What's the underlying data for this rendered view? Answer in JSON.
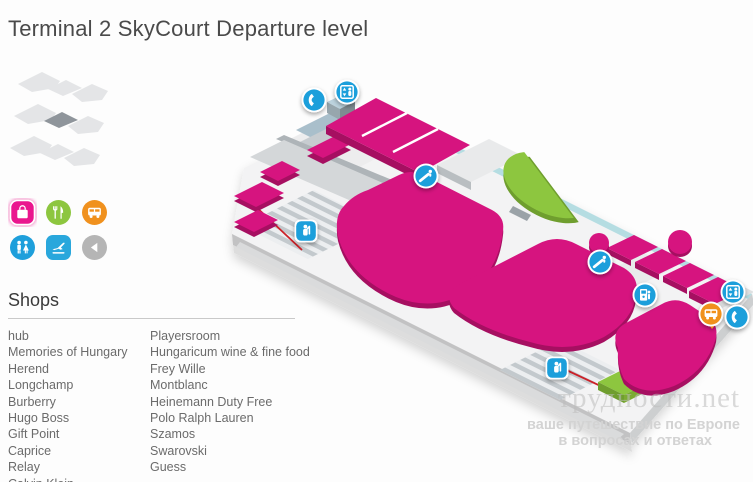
{
  "title": "Terminal 2 SkyCourt Departure level",
  "level_selector": {
    "floors_shown": 3,
    "active_floor_index": 1
  },
  "legend": {
    "items": [
      {
        "id": "shops",
        "icon": "shopping-bag-icon",
        "shape": "rounded-square",
        "color": "#ea168e",
        "active": true
      },
      {
        "id": "restaurants",
        "icon": "fork-knife-icon",
        "shape": "circle",
        "color": "#8dc63f",
        "active": false
      },
      {
        "id": "transport",
        "icon": "bus-icon",
        "shape": "circle",
        "color": "#f0911e",
        "active": false
      },
      {
        "id": "restrooms",
        "icon": "restroom-icon",
        "shape": "circle",
        "color": "#1e9fdb",
        "active": false
      },
      {
        "id": "departures",
        "icon": "plane-departure-icon",
        "shape": "rounded-square",
        "color": "#29a7dc",
        "active": false
      },
      {
        "id": "back",
        "icon": "back-arrow-icon",
        "shape": "circle",
        "color": "#b5b5b5",
        "active": false
      }
    ]
  },
  "shops": {
    "heading": "Shops",
    "columns": [
      [
        "hub",
        "Memories of Hungary",
        "Herend",
        "Longchamp",
        "Burberry",
        "Hugo Boss",
        "Gift Point",
        "Caprice",
        "Relay",
        "Calvin Klein"
      ],
      [
        "Playersroom",
        "Hungaricum wine & fine food",
        "Frey Wille",
        "Montblanc",
        "Heinemann Duty Free",
        "Polo Ralph Lauren",
        "Szamos",
        "Swarovski",
        "Guess"
      ]
    ]
  },
  "map": {
    "markers": [
      {
        "id": "telephone-upper",
        "icon": "telephone-icon",
        "color": "#1e9fdb"
      },
      {
        "id": "elevator-upper",
        "icon": "elevator-icon",
        "color": "#1e9fdb"
      },
      {
        "id": "escalator-center",
        "icon": "escalator-icon",
        "color": "#1e9fdb"
      },
      {
        "id": "security-check-west",
        "icon": "security-check-icon",
        "color": "#1e9fdb"
      },
      {
        "id": "escalator-east",
        "icon": "escalator-icon",
        "color": "#1e9fdb"
      },
      {
        "id": "atm",
        "icon": "atm-icon",
        "color": "#1e9fdb"
      },
      {
        "id": "elevator-east",
        "icon": "elevator-icon",
        "color": "#1e9fdb"
      },
      {
        "id": "bus",
        "icon": "bus-icon",
        "color": "#f0911e"
      },
      {
        "id": "telephone-east",
        "icon": "telephone-icon",
        "color": "#1e9fdb"
      },
      {
        "id": "security-check-south",
        "icon": "security-check-icon",
        "color": "#1e9fdb"
      }
    ],
    "areas": [
      {
        "id": "shop-areas",
        "color": "#d6147f"
      },
      {
        "id": "food-court-areas",
        "color": "#8dc63f"
      },
      {
        "id": "security-lanes",
        "color": "#c3c9cd"
      },
      {
        "id": "terrace-edge",
        "color": "#b5dde2"
      }
    ]
  },
  "watermark": {
    "domain": "трудности.net",
    "tagline_line1": "ваше путешествие по Европе",
    "tagline_line2": "в вопросах и ответах"
  },
  "colors": {
    "magenta": "#d6147f",
    "magenta_dark": "#a60f61",
    "green": "#8dc63f",
    "green_dark": "#6f9e2e",
    "marker_blue": "#1e9fdb",
    "orange": "#f0911e",
    "teal_edge": "#b5dde2",
    "legend_pink": "#ea168e",
    "legend_departures_blue": "#29a7dc",
    "legend_gray": "#b5b5b5"
  }
}
